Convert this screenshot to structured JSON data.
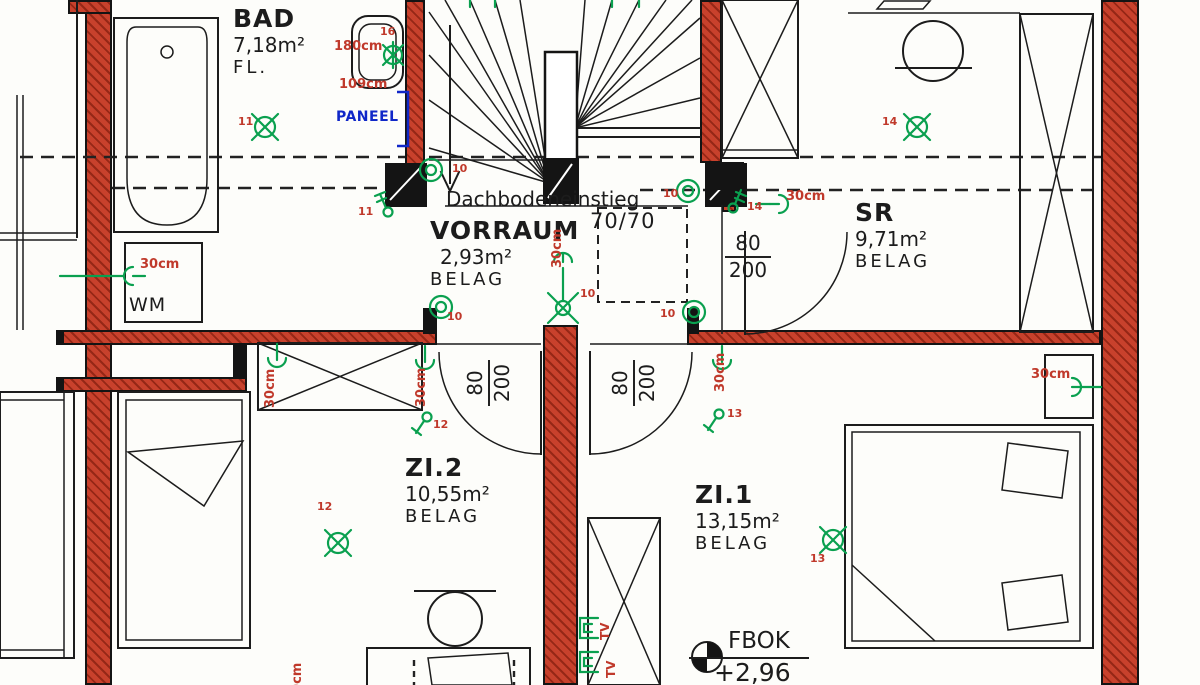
{
  "plan": {
    "rooms": [
      {
        "id": "bad",
        "name": "BAD",
        "area": "7,18m²",
        "finish": "FL."
      },
      {
        "id": "vorraum",
        "name": "VORRAUM",
        "area": "2,93m²",
        "finish": "BELAG"
      },
      {
        "id": "sr",
        "name": "SR",
        "area": "9,71m²",
        "finish": "BELAG"
      },
      {
        "id": "zi2",
        "name": "ZI.2",
        "area": "10,55m²",
        "finish": "BELAG"
      },
      {
        "id": "zi1",
        "name": "ZI.1",
        "area": "13,15m²",
        "finish": "BELAG"
      }
    ],
    "stair": {
      "attic_label": "Dachbodeneinstieg",
      "attic_size": "70/70"
    },
    "level_marker": {
      "label": "FBOK",
      "value": "+2,96"
    },
    "fixtures": {
      "washing_machine": "WM",
      "panel": "PANEEL"
    },
    "doors": [
      {
        "id": "door-zi2",
        "width": "80",
        "height": "200"
      },
      {
        "id": "door-zi1",
        "width": "80",
        "height": "200"
      },
      {
        "id": "door-sr",
        "width": "80",
        "height": "200"
      }
    ],
    "annotations": [
      {
        "text": "180cm",
        "x": 334,
        "y": 40,
        "size": 13
      },
      {
        "text": "109cm",
        "x": 339,
        "y": 78,
        "size": 13
      },
      {
        "text": "30cm",
        "x": 140,
        "y": 258,
        "size": 13
      },
      {
        "text": "30cm",
        "x": 786,
        "y": 190,
        "size": 13
      },
      {
        "text": "30cm",
        "x": 551,
        "y": 268,
        "size": 13,
        "rot": true
      },
      {
        "text": "30cm",
        "x": 264,
        "y": 408,
        "size": 13,
        "rot": true
      },
      {
        "text": "30cm",
        "x": 415,
        "y": 407,
        "size": 13,
        "rot": true
      },
      {
        "text": "30cm",
        "x": 714,
        "y": 392,
        "size": 13,
        "rot": true
      },
      {
        "text": "30cm",
        "x": 1031,
        "y": 368,
        "size": 13
      },
      {
        "text": "30cm",
        "x": 291,
        "y": 702,
        "size": 13,
        "rot": true
      },
      {
        "text": "TV",
        "x": 599,
        "y": 640,
        "size": 12,
        "rot": true
      },
      {
        "text": "TV",
        "x": 605,
        "y": 678,
        "size": 12,
        "rot": true
      },
      {
        "text": "11",
        "x": 238,
        "y": 116,
        "size": 11
      },
      {
        "text": "16",
        "x": 380,
        "y": 26,
        "size": 11
      },
      {
        "text": "11",
        "x": 358,
        "y": 206,
        "size": 11
      },
      {
        "text": "10",
        "x": 452,
        "y": 163,
        "size": 11
      },
      {
        "text": "10",
        "x": 663,
        "y": 188,
        "size": 11
      },
      {
        "text": "10",
        "x": 580,
        "y": 288,
        "size": 11
      },
      {
        "text": "10",
        "x": 447,
        "y": 311,
        "size": 11
      },
      {
        "text": "10",
        "x": 660,
        "y": 308,
        "size": 11
      },
      {
        "text": "14",
        "x": 747,
        "y": 201,
        "size": 11
      },
      {
        "text": "14",
        "x": 882,
        "y": 116,
        "size": 11
      },
      {
        "text": "12",
        "x": 433,
        "y": 419,
        "size": 11
      },
      {
        "text": "12",
        "x": 317,
        "y": 501,
        "size": 11
      },
      {
        "text": "13",
        "x": 727,
        "y": 408,
        "size": 11
      },
      {
        "text": "13",
        "x": 810,
        "y": 553,
        "size": 11
      }
    ],
    "colors": {
      "wall_red": "#c8412c",
      "wall_hatch": "#962716",
      "line_color": "#1c1c1c",
      "green": "#0aa04f",
      "red": "#c0392b",
      "blue": "#1027c8"
    }
  }
}
